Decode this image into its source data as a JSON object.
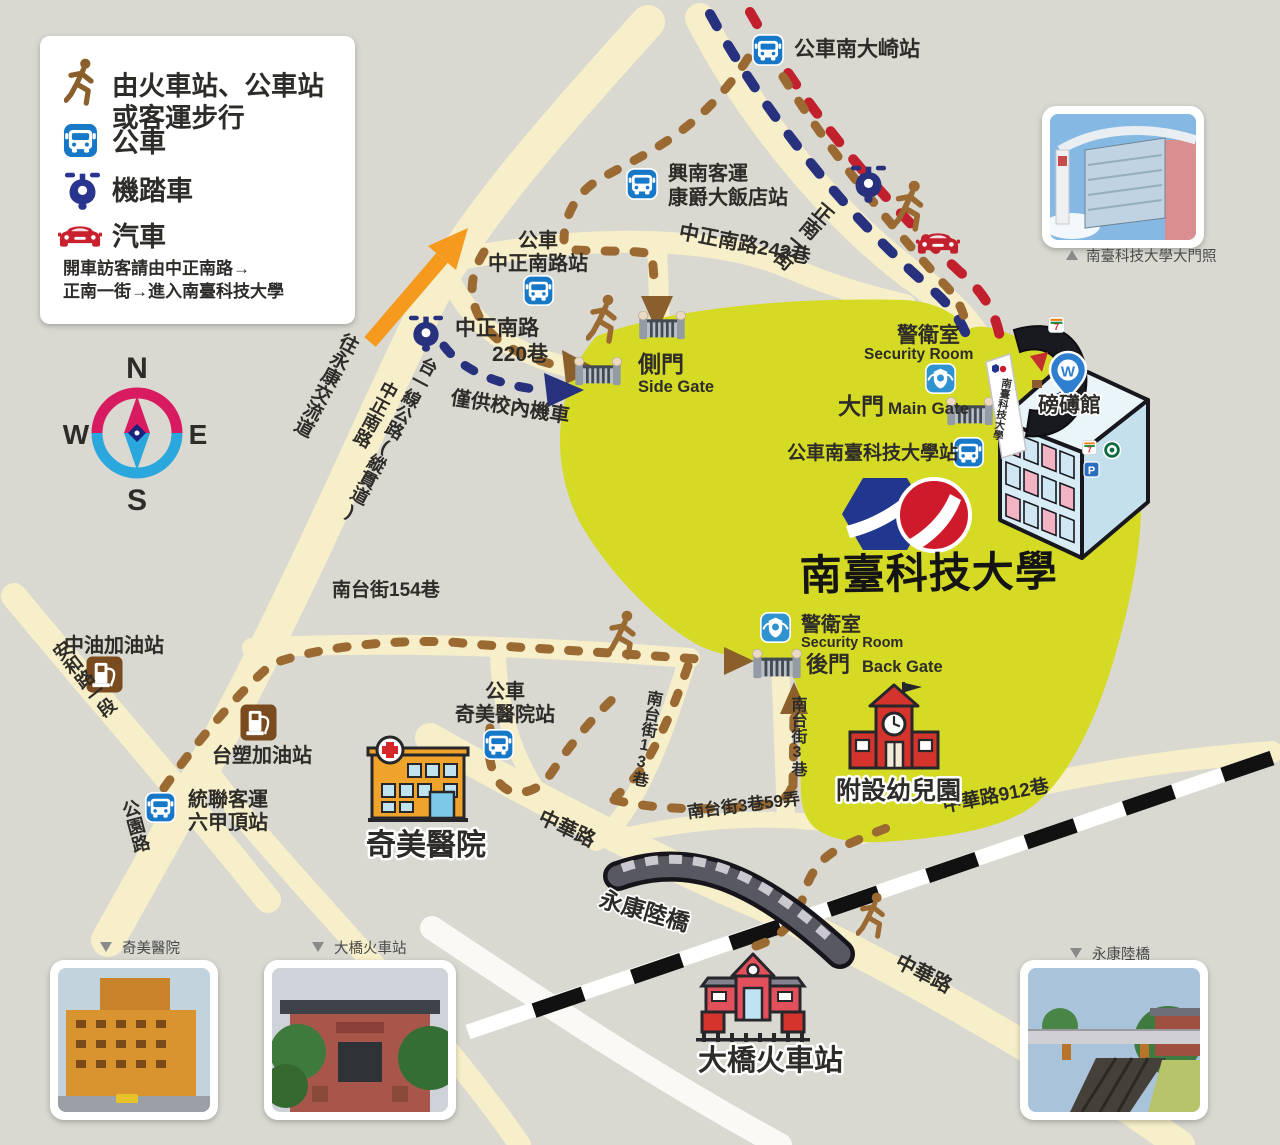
{
  "legend": {
    "walk_line1": "由火車站、公車站",
    "walk_line2": "或客運步行",
    "bus": "公車",
    "scooter": "機踏車",
    "car": "汽車",
    "note_line1": "開車訪客請由中正南路→",
    "note_line2": "正南一街→進入南臺科技大學"
  },
  "compass": {
    "n": "N",
    "e": "E",
    "s": "S",
    "w": "W"
  },
  "bus_stops": {
    "nandaqi": "公車南大崎站",
    "xingnan_line1": "興南客運",
    "xingnan_line2": "康爵大飯店站",
    "zhongzheng_line1": "公車",
    "zhongzheng_line2": "中正南路站",
    "stust": "公車南臺科技大學站",
    "chimei_line1": "公車",
    "chimei_line2": "奇美醫院站",
    "tonglian_line1": "統聯客運",
    "tonglian_line2": "六甲頂站"
  },
  "roads": {
    "zhengnan_242": "中正南路242巷",
    "zhengnan_1st": "正南一街",
    "taiyi": "台一線公路(縱貫道)",
    "zhongzheng_south": "中正南路",
    "lane220_line1": "中正南路",
    "lane220_line2": "220巷",
    "to_yongkang_ic": "往永康交流道",
    "anhe": "安和路一段",
    "gongyuan": "公園路",
    "nantai154": "南台街154巷",
    "nantai13": "南台街13巷",
    "nantai3": "南台街3巷",
    "nantai3_59": "南台街3巷59弄",
    "zhonghua912": "中華路912巷",
    "zhonghua_west": "中華路",
    "zhonghua_south": "中華路"
  },
  "gates": {
    "side_zh": "側門",
    "side_en": "Side Gate",
    "main_zh": "大門",
    "main_en": "Main Gate",
    "back_zh": "後門",
    "back_en": "Back Gate",
    "guard_zh": "警衛室",
    "guard_en": "Security Room"
  },
  "places": {
    "university": "南臺科技大學",
    "pangbo_hall": "磅礡館",
    "kindergarten": "附設幼兒園",
    "hospital": "奇美醫院",
    "train_station": "大橋火車站",
    "bridge": "永康陸橋",
    "cpc_station": "中油加油站",
    "fpc_station": "台塑加油站",
    "scooter_only_note": "僅供校內機車"
  },
  "photo_captions": {
    "main_gate_photo": "南臺科技大學大門照",
    "hospital_photo": "奇美醫院",
    "station_photo": "大橋火車站",
    "bridge_photo": "永康陸橋"
  },
  "colors": {
    "background": "#d9d8d1",
    "road": "#f7efc9",
    "campus_area": "#d5da25",
    "bus_blue": "#1878c8",
    "route_scooter_navy": "#27317e",
    "route_car_red": "#c3202e",
    "route_walk_brown": "#9a6a32",
    "legend_note_pink": "#e0506a",
    "highway_arrow_orange": "#f59a1d"
  }
}
